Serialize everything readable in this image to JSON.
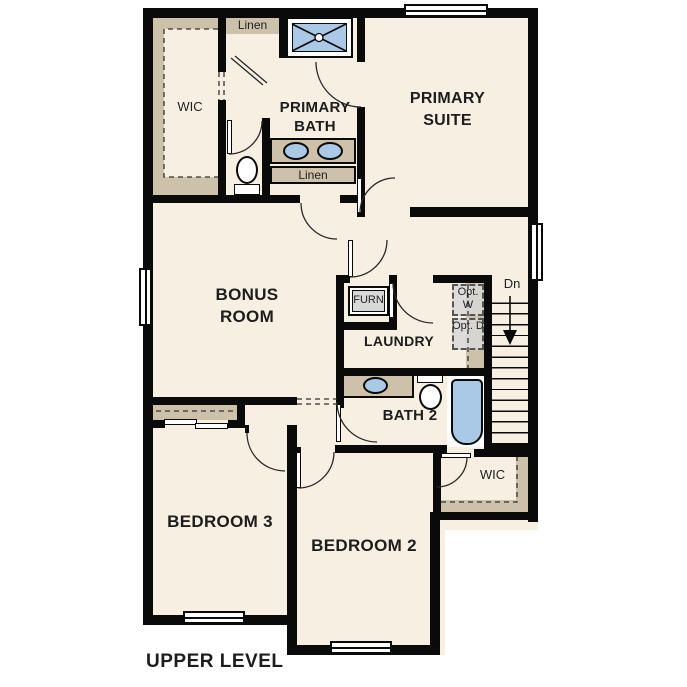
{
  "title": "UPPER LEVEL",
  "colors": {
    "floor": "#f7efe2",
    "wall": "#0a0a0a",
    "tan": "#cdc1aa",
    "blue": "#a9c9e7",
    "gray": "#d8d8d8",
    "text": "#1d1d1d"
  },
  "rooms": {
    "wic_primary": "WIC",
    "linen_top": "Linen",
    "primary_bath": "PRIMARY BATH",
    "primary_suite": "PRIMARY SUITE",
    "linen_hall": "Linen",
    "bonus_room": "BONUS ROOM",
    "furnace": "FURN",
    "laundry": "LAUNDRY",
    "opt_washer": "Opt. W",
    "opt_dryer": "Opt. D",
    "stairs_down": "Dn",
    "bath_2": "BATH 2",
    "wic_bedroom2": "WIC",
    "bedroom_3": "BEDROOM 3",
    "bedroom_2": "BEDROOM 2"
  }
}
